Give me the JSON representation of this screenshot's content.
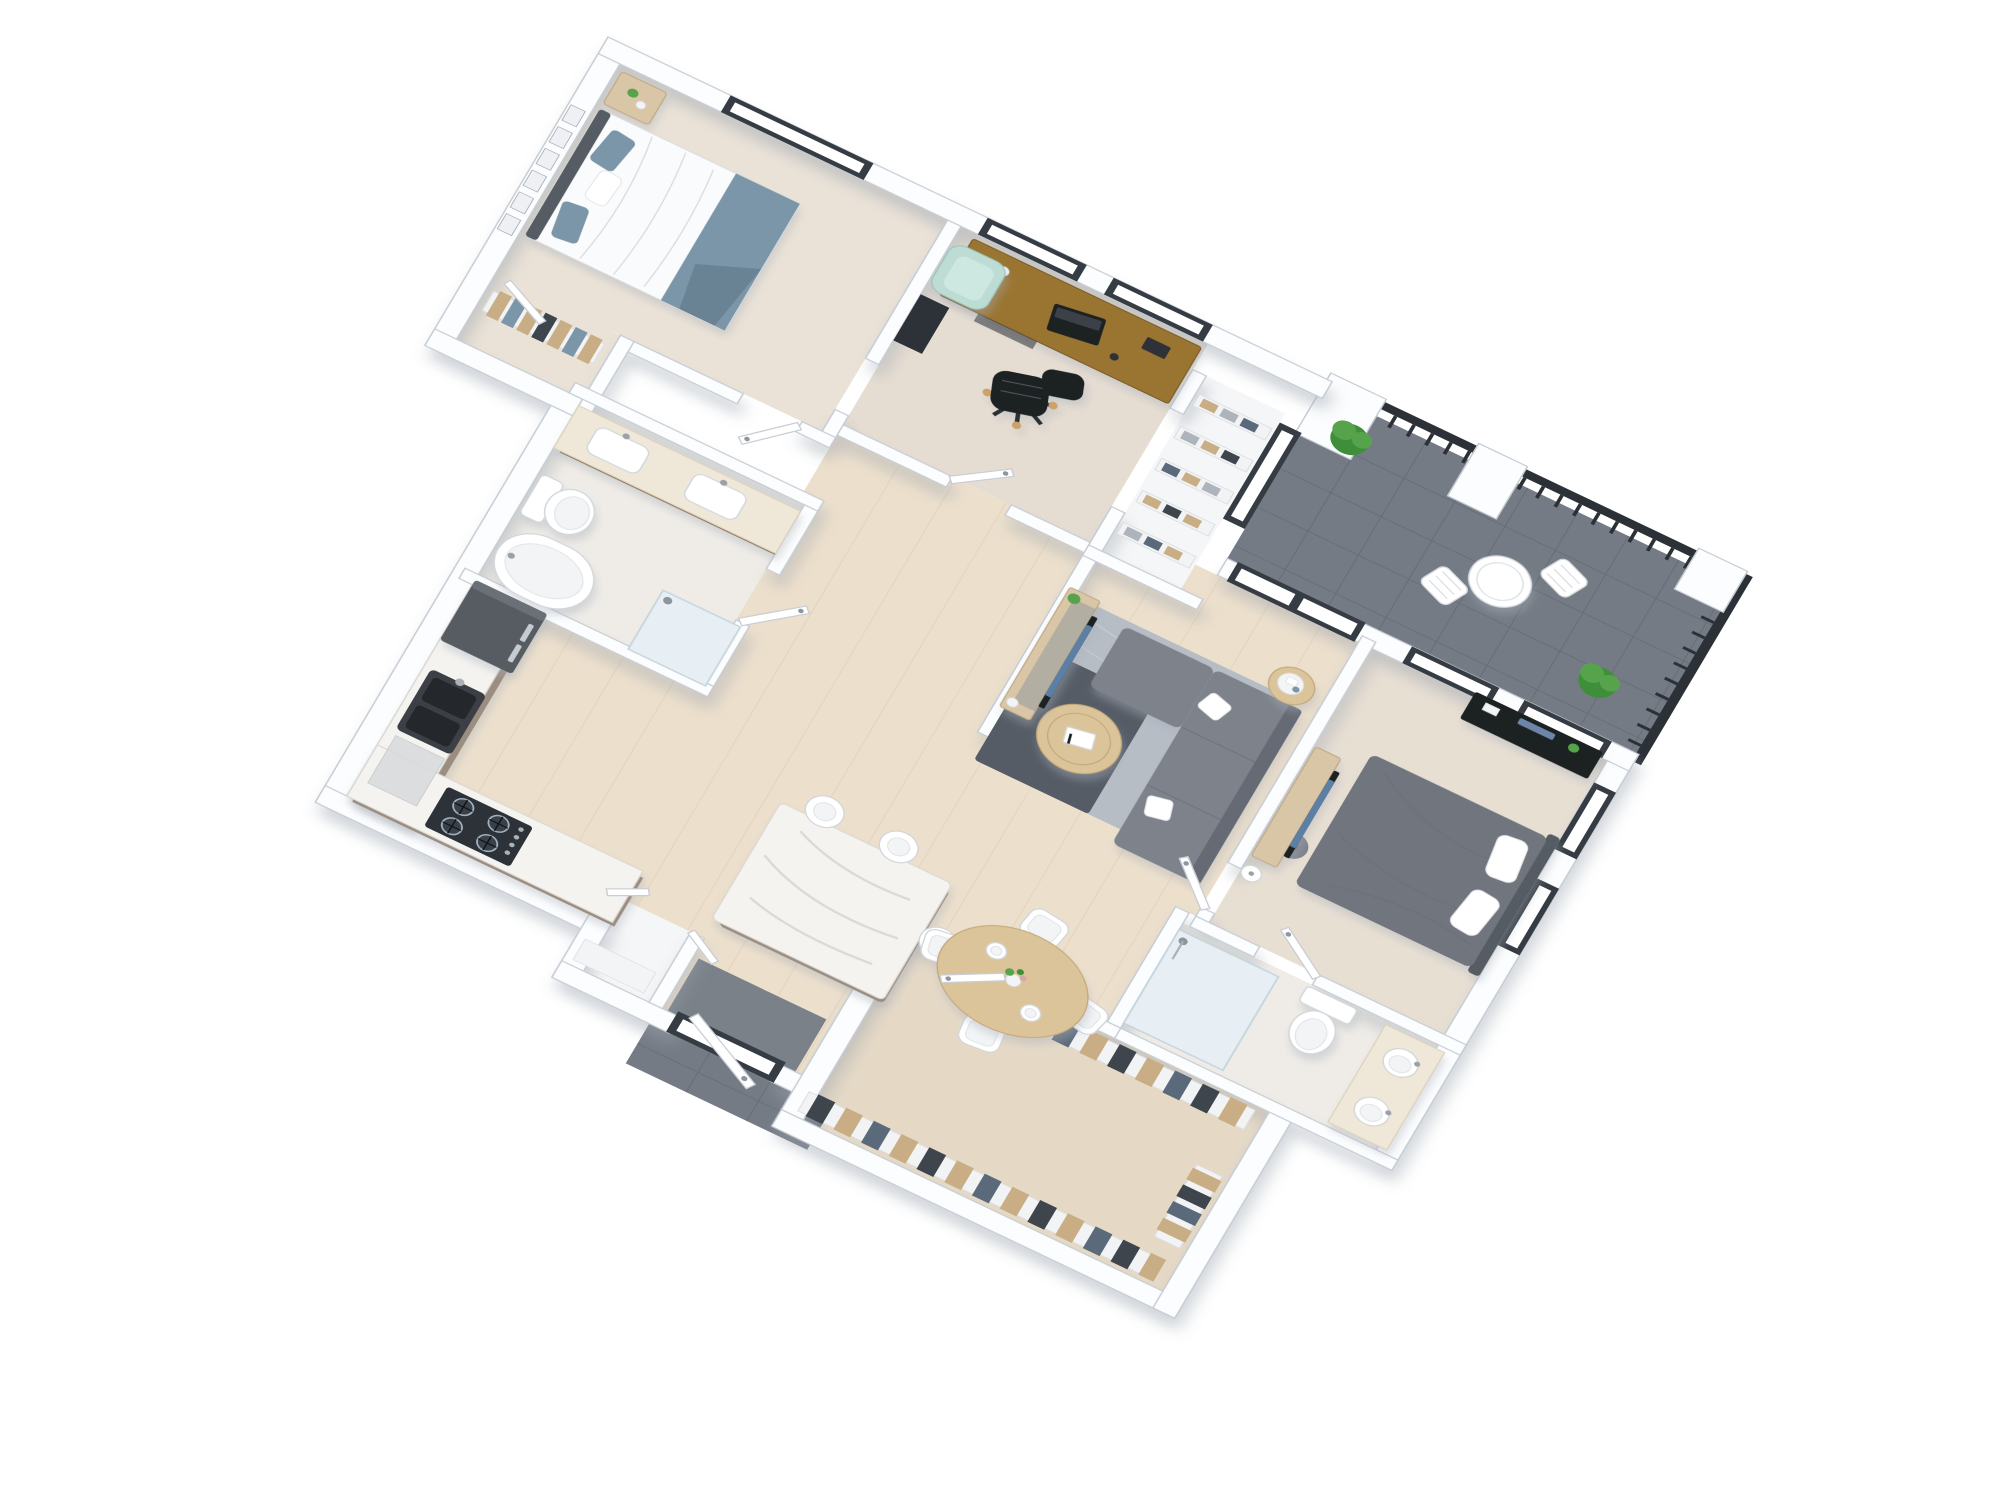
{
  "scene": {
    "title": "3D isometric floor plan render — two-bedroom apartment with balcony",
    "style": "photoreal 3D dollhouse view, white walls, warm wood floors, white background",
    "projection": "rotated isometric, north wall at upper left"
  },
  "colors": {
    "wall": "#fcfdfe",
    "wall-line": "#c6ccd4",
    "wood": "#ecdfcc",
    "wood-line": "#decdb6",
    "carpet": "#eae2d7",
    "carpet2": "#e6ddd2",
    "carpet3": "#e8dfd3",
    "carpet-cl": "#e5d9c6",
    "bath-floor": "#efece7",
    "tile-dark": "#747b84",
    "tile-line": "#656c75",
    "frame": "#363c43",
    "glass": "#ffffff",
    "rail": "#2c3137",
    "oak": "#d9c6a6",
    "oak-line": "#c0ab88",
    "desk": "#9a7433",
    "desk-line": "#7c5d28",
    "table": "#dcc49a",
    "table-line": "#c3a878",
    "marble": "#f4f3f0",
    "marble-line": "#dbd8d1",
    "cab": "#9b8d80",
    "appl": "#565b62",
    "appl-dark": "#2d3238",
    "sink": "#3c4046",
    "sofa": "#7d828b",
    "sofa-dark": "#666b74",
    "rug1": "#b7bdc5",
    "rug2": "#555c66",
    "bed2-duvet": "#fafbfc",
    "blue": "#7b96a9",
    "blue-dark": "#698294",
    "mbed": "#70757e",
    "mbed-dark": "#565b63",
    "black": "#1d2024",
    "mint": "#bcdcd4",
    "white-fix": "#ffffff",
    "fix-line": "#d2d7db",
    "vanity": "#8a6f52",
    "vanity-top": "#efe7d8",
    "green": "#3f8f3a",
    "green2": "#57a34b",
    "cloth-tan": "#c9ae85",
    "cloth-dark": "#3f454d",
    "cloth-navy": "#5b6a7a"
  },
  "rooms": [
    {
      "id": "bedroom-2",
      "name": "Bedroom 2",
      "floor": "beige carpet",
      "furniture": [
        "double bed with white duvet",
        "blue throw blanket",
        "two blue pillows",
        "gray headboard",
        "nightstand with flowers",
        "gallery wall art frames",
        "reach-in closet with hanging clothes"
      ]
    },
    {
      "id": "office",
      "name": "Home Office",
      "floor": "beige carpet",
      "furniture": [
        "wood desk",
        "laptop",
        "desk accessories",
        "black swivel office chair",
        "mint accent chair",
        "dark media shelf"
      ]
    },
    {
      "id": "hall-closet",
      "name": "Hall Linen Closet",
      "floor": "white",
      "furniture": [
        "five open shelves with folded linens"
      ]
    },
    {
      "id": "main-bathroom",
      "name": "Main Bathroom",
      "floor": "light tile",
      "furniture": [
        "double vanity with two rectangular sinks",
        "toilet",
        "freestanding bathtub",
        "walk-in shower"
      ]
    },
    {
      "id": "living-room",
      "name": "Living Room",
      "floor": "light wood",
      "furniture": [
        "gray sectional sofa with chaise",
        "two white throw pillows",
        "two-tone area rug",
        "round wood coffee table with book",
        "round side table with tray",
        "oak TV console with television",
        "small potted plant"
      ]
    },
    {
      "id": "master-bedroom",
      "name": "Master Bedroom",
      "floor": "beige carpet",
      "furniture": [
        "bed with charcoal duvet",
        "two white pillows",
        "black dresser with decor",
        "oak TV console with television",
        "floor lamp",
        "round gray stool"
      ]
    },
    {
      "id": "master-bathroom",
      "name": "Master Bathroom",
      "floor": "light tile",
      "furniture": [
        "glass walk-in shower",
        "toilet",
        "double vanity with two round vessel sinks"
      ]
    },
    {
      "id": "walk-in-closet",
      "name": "Walk-in Closet",
      "floor": "beige carpet",
      "furniture": [
        "north hanging rail with clothes",
        "south hanging rail with clothes",
        "corner rail with clothes"
      ]
    },
    {
      "id": "kitchen",
      "name": "Kitchen",
      "floor": "light wood",
      "furniture": [
        "dark refrigerator",
        "L-shaped marble counter",
        "dark double-bowl sink",
        "dishwasher",
        "gas cooktop with four burners",
        "marble waterfall island",
        "three white bar stools"
      ]
    },
    {
      "id": "dining-area",
      "name": "Dining Area",
      "floor": "light wood",
      "furniture": [
        "round wood dining table",
        "four cream upholstered chairs",
        "vase with flowers",
        "two place settings"
      ]
    },
    {
      "id": "entry",
      "name": "Entry",
      "floor": "wood with dark tile landing",
      "furniture": [
        "dark-framed front door",
        "exterior tile walkway",
        "laundry closet with double doors"
      ]
    },
    {
      "id": "balcony",
      "name": "Balcony",
      "floor": "dark gray tile",
      "furniture": [
        "black metal guard railing",
        "three white pillars",
        "white bistro table",
        "two white folding chairs",
        "two potted plants"
      ]
    }
  ],
  "counts": {
    "bedrooms": 2,
    "bathrooms": 2,
    "balconies": 1,
    "bar_stools": 3,
    "dining_chairs": 4,
    "windows": 10,
    "interior_doors": 9
  }
}
